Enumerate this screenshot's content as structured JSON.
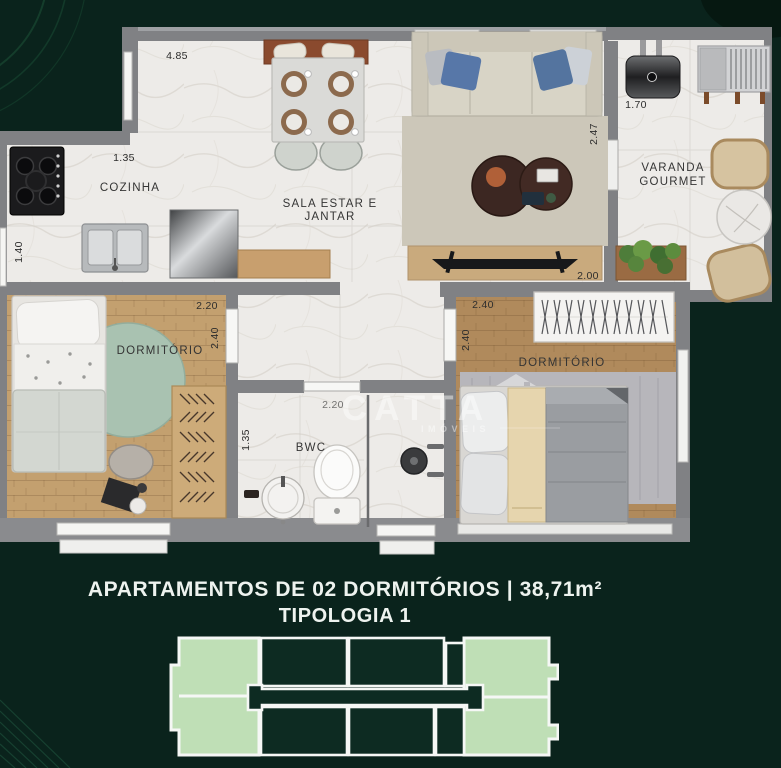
{
  "colors": {
    "background": "#0a231c",
    "wall_gray": "#808184",
    "keyplan_highlight": "#bfdfb6",
    "keyplan_dark": "#0d2b22",
    "caption_text": "#eef3ef"
  },
  "caption": {
    "line1": "APARTAMENTOS DE 02 DORMITÓRIOS | 38,71m²",
    "line2": "TIPOLOGIA 1"
  },
  "watermark": {
    "brand": "CATTA",
    "subtitle": "IMÓVEIS"
  },
  "floor_plan": {
    "rooms": {
      "kitchen": {
        "label": "COZINHA"
      },
      "living_dining": {
        "label_line1": "SALA ESTAR E",
        "label_line2": "JANTAR"
      },
      "gourmet_balcony": {
        "label_line1": "VARANDA",
        "label_line2": "GOURMET"
      },
      "bedroom_left": {
        "label": "DORMITÓRIO"
      },
      "bedroom_right": {
        "label": "DORMITÓRIO"
      },
      "bathroom": {
        "label": "BWC"
      }
    },
    "dimensions": {
      "living_top": "4.85",
      "kitchen_width": "1.35",
      "kitchen_depth": "1.40",
      "living_side": "2.47",
      "balcony_width": "1.70",
      "living_bottom": "2.00",
      "bedroom_left_width": "2.20",
      "bedroom_left_depth": "2.40",
      "hall_width": "2.20",
      "bathroom_depth": "1.35",
      "bedroom_right_width": "2.40",
      "bedroom_right_depth": "2.40"
    }
  }
}
